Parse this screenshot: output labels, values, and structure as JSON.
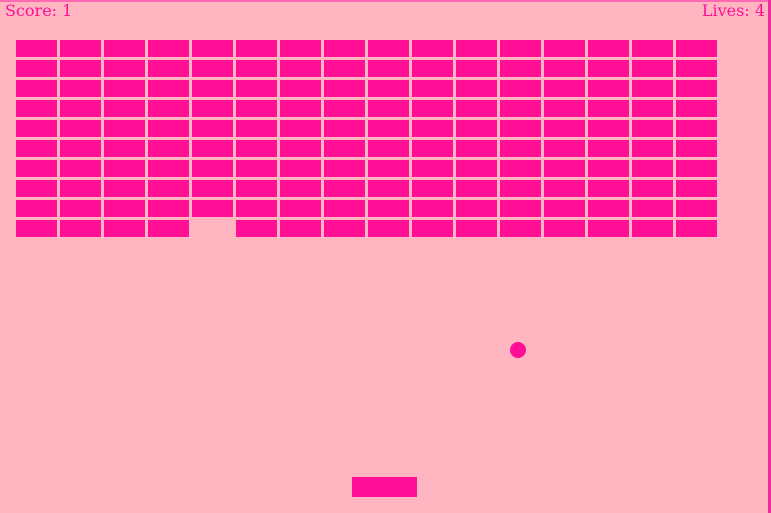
{
  "window": {
    "width": 771,
    "height": 513
  },
  "colors": {
    "background": "#ffb6c1",
    "foreground": "#ff0e96",
    "top_border": "#ff69b4",
    "right_edge": "#ee2d9c"
  },
  "hud": {
    "score_text": "Score: 1",
    "lives_text": "Lives: 4"
  },
  "bricks": {
    "rows": 10,
    "cols": 16,
    "origin_x": 15.5,
    "origin_y": 40,
    "pitch_x": 44.05,
    "pitch_y": 20,
    "brick_width": 41,
    "brick_height": 17,
    "missing": [
      {
        "row": 9,
        "col": 4
      }
    ]
  },
  "ball": {
    "cx": 518,
    "cy": 350,
    "radius": 8
  },
  "paddle": {
    "x": 352,
    "y": 477,
    "width": 65,
    "height": 20
  }
}
